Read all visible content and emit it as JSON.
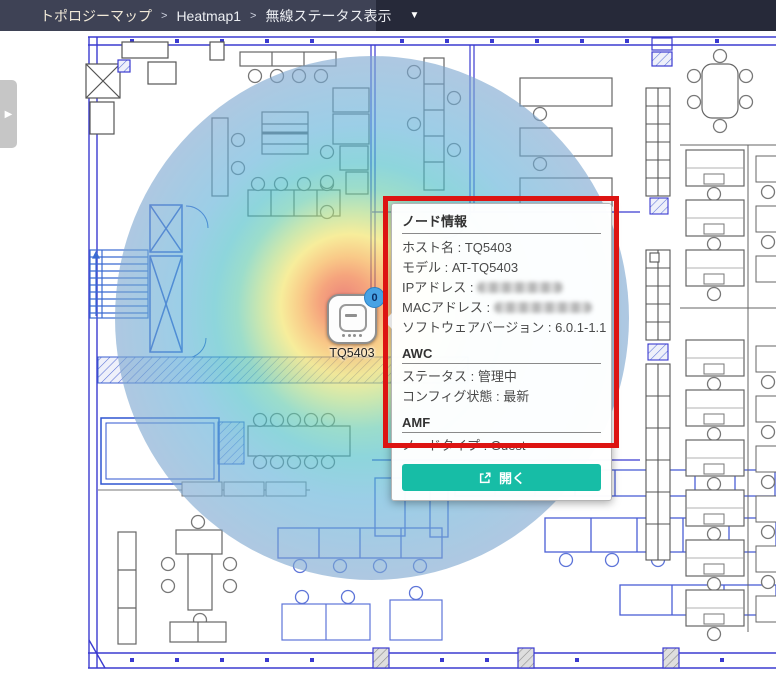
{
  "breadcrumb": {
    "items": [
      "トポロジーマップ",
      "Heatmap1",
      "無線ステータス表示"
    ],
    "separator": ">",
    "caret": "▼"
  },
  "panel_toggle": {
    "icon": "▶"
  },
  "map": {
    "ap_label": "TQ5403",
    "ap_badge": "0"
  },
  "popup": {
    "title": "ノード情報",
    "colon": " : ",
    "rows": [
      {
        "label": "ホスト名",
        "value": "TQ5403"
      },
      {
        "label": "モデル",
        "value": "AT-TQ5403"
      },
      {
        "label": "IPアドレス",
        "value": "",
        "redacted": true
      },
      {
        "label": "MACアドレス",
        "value": "",
        "redacted": true
      },
      {
        "label": "ソフトウェアバージョン",
        "value": "6.0.1-1.1"
      }
    ],
    "sections": [
      {
        "title": "AWC",
        "rows": [
          {
            "label": "ステータス",
            "value": "管理中"
          },
          {
            "label": "コンフィグ状態",
            "value": "最新"
          }
        ]
      },
      {
        "title": "AMF",
        "rows": [
          {
            "label": "ノードタイプ",
            "value": "Guest"
          }
        ]
      }
    ],
    "open_button": "開く"
  },
  "colors": {
    "topbar_bg": "#262939",
    "breadcrumb_bg": "#3e4255",
    "annotation_red": "#dd1412",
    "open_button_teal": "#17bda6",
    "badge_blue": "#47a2e4",
    "wall_blue": "#3b3bd0"
  },
  "heatmap": {
    "stops": [
      "#e0392c",
      "#ef6c2d",
      "#f5a93f",
      "#f2e25e",
      "#acd97e",
      "#5fc8ab",
      "#48bcc6",
      "#5fb0d8",
      "#7da6cf"
    ]
  }
}
